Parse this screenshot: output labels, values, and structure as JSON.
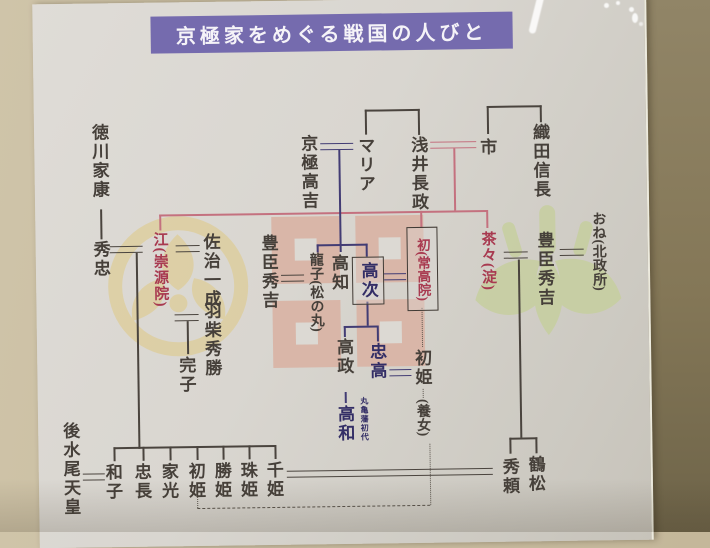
{
  "title": "京極家をめぐる戦国の人びと",
  "people": {
    "tokugawa_ieyasu": "徳川家康",
    "hidetada": "秀忠",
    "go": "江(崇源院)",
    "saji_kazunari": "佐治一成",
    "hashiba_hidekatsu": "羽柴秀勝",
    "sadako": "完子",
    "kyogoku_takayoshi": "京極高吉",
    "maria": "マリア",
    "azai_nagamasa": "浅井長政",
    "ichi": "市",
    "oda_nobunaga": "織田信長",
    "toyotomi_hideyoshi_left": "豊臣秀吉",
    "tatsuko": "龍子(松の丸)",
    "takatomo": "高知",
    "takatsugu": "高次",
    "hatsu": "初(常高院)",
    "chacha": "茶々(淀)",
    "toyotomi_hideyoshi_right": "豊臣秀吉",
    "one": "おね(北政所)",
    "takamasa": "高政",
    "tadataka": "忠高",
    "takakazu": "高和",
    "hatsuhime_adopted": "初姫",
    "adopted_note": "(養女)",
    "gomizunoo_tenno": "後水尾天皇",
    "kazuko": "和子",
    "tadanaga": "忠長",
    "iemitsu": "家光",
    "hatsuhime": "初姫",
    "katsuhime": "勝姫",
    "tamahime": "珠姫",
    "senhime": "千姫",
    "tsurumatsu": "鶴松",
    "hideyori": "秀頼"
  },
  "notes": {
    "marugame": "丸亀藩初代"
  },
  "colors": {
    "banner_bg": "#756bae",
    "banner_text": "#f5f3f8",
    "lineage_pink": "#c4717f",
    "kyogoku_navy": "#423c74",
    "highlight_red": "#a83a50",
    "ink": "#46403a",
    "paper": "#d9d6d0",
    "wall": "#c9bd9f",
    "crest_gold": "#dfc87c",
    "crest_pink": "#d9b6a8",
    "crest_green": "#c6cf9d"
  }
}
